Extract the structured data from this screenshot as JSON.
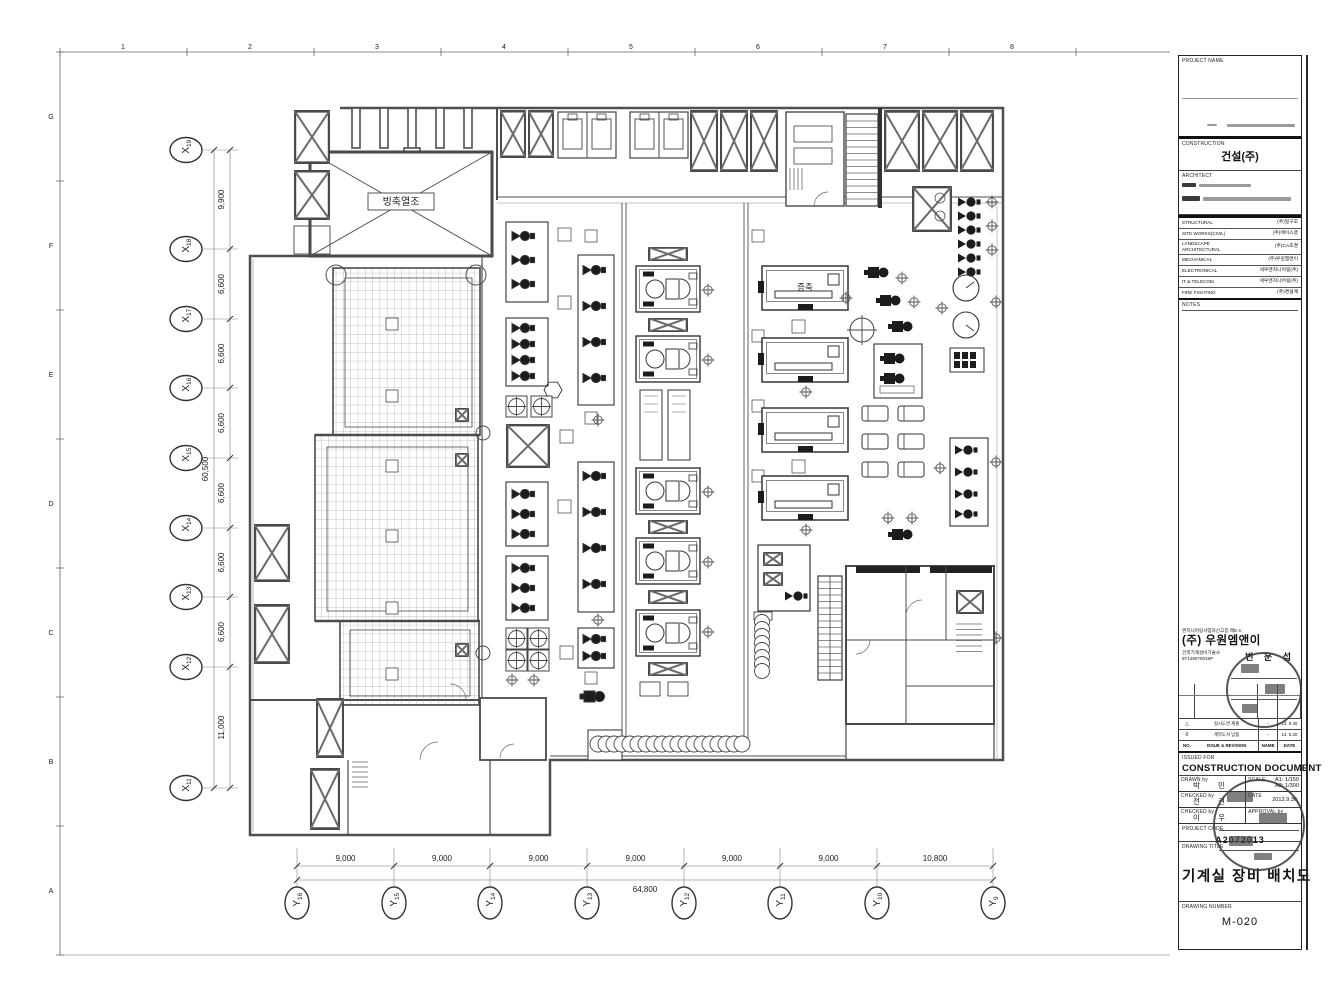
{
  "sheet": {
    "ruler_numbers": [
      "1",
      "2",
      "3",
      "4",
      "5",
      "6",
      "7",
      "8"
    ],
    "ruler_letters": [
      "G",
      "F",
      "E",
      "D",
      "C",
      "B",
      "A"
    ]
  },
  "plan": {
    "labels": {
      "ice_tank": "빙축열조",
      "extension": "증축"
    }
  },
  "grid": {
    "x_bubbles": [
      {
        "p": "X",
        "n": "19"
      },
      {
        "p": "X",
        "n": "18"
      },
      {
        "p": "X",
        "n": "17"
      },
      {
        "p": "X",
        "n": "16"
      },
      {
        "p": "X",
        "n": "15"
      },
      {
        "p": "X",
        "n": "14"
      },
      {
        "p": "X",
        "n": "13"
      },
      {
        "p": "X",
        "n": "12"
      },
      {
        "p": "X",
        "n": "11"
      }
    ],
    "x_dims": [
      "9,900",
      "6,600",
      "6,600",
      "6,600",
      "6,600",
      "6,600",
      "6,600",
      "11,000"
    ],
    "x_total": "60,500",
    "y_bubbles": [
      {
        "p": "Y",
        "n": "16"
      },
      {
        "p": "Y",
        "n": "15"
      },
      {
        "p": "Y",
        "n": "14"
      },
      {
        "p": "Y",
        "n": "13"
      },
      {
        "p": "Y",
        "n": "12"
      },
      {
        "p": "Y",
        "n": "11"
      },
      {
        "p": "Y",
        "n": "10"
      },
      {
        "p": "Y",
        "n": "9"
      }
    ],
    "y_dims": [
      "9,000",
      "9,000",
      "9,000",
      "9,000",
      "9,000",
      "9,000",
      "10,800"
    ],
    "y_total": "64,800"
  },
  "titleblock": {
    "project_name_label": "PROJECT NAME",
    "construction_label": "CONSTRUCTION",
    "construction_value": "건설(주)",
    "architect_label": "ARCHITECT",
    "consultants": [
      {
        "label": "STRUCTURAL",
        "value": "(주)일구조"
      },
      {
        "label": "SITE WORKS(CIVIL)",
        "value": "(주)에이스글"
      },
      {
        "label": "LANDSCAPE ARCHITECTURAL",
        "value": "(주)CA조경"
      },
      {
        "label": "MECHANICAL",
        "value": "(주)우원엠앤이"
      },
      {
        "label": "ELECTRONICAL",
        "value": "세우엔지니어링(주)"
      },
      {
        "label": "IT & TELECOM",
        "value": "세우엔지니어링(주)"
      },
      {
        "label": "FIRE FIGHTING",
        "value": "(주)경설계"
      }
    ],
    "notes_label": "NOTES",
    "company": {
      "reg_line": "엔지니어링사업자신고증 제E-1-",
      "name": "(주) 우원엠앤이",
      "license": "건축기계설비기술사",
      "license_no": "97149070016P",
      "engineer_name": "변 운 섭"
    },
    "revisions": [
      {
        "no": "△",
        "desc": "실시도면 제출",
        "name": "-",
        "date": "13. 9.30"
      },
      {
        "no": "0",
        "desc": "계약도서 납품",
        "name": "-",
        "date": "13. 5.20"
      }
    ],
    "revision_header": {
      "no": "NO.",
      "desc": "ISSUE & REVISION",
      "name": "NAME",
      "date": "DATE"
    },
    "issued_for_label": "ISSUED FOR",
    "issued_for_value": "CONSTRUCTION DOCUMENT",
    "drawn_by": {
      "label": "DRAWN by",
      "value": "박  민"
    },
    "checked_by1": {
      "label": "CHECKED by",
      "value": "전  권"
    },
    "checked_by2": {
      "label": "CHECKED by",
      "value": "이  우"
    },
    "scale": {
      "label": "SCALE",
      "a1": "A1:  1/150",
      "a3": "A3:  1/300"
    },
    "date": {
      "label": "DATE",
      "value": "2013.9.30"
    },
    "approval_label": "APPROVAL by",
    "project_code": {
      "label": "PROJECT CODE",
      "value": "A2072013"
    },
    "drawing_title": {
      "label": "DRAWING TITLE",
      "value": "기계실 장비 배치도"
    },
    "drawing_number": {
      "label": "DRAWING NUMBER",
      "value": "M-020"
    }
  }
}
